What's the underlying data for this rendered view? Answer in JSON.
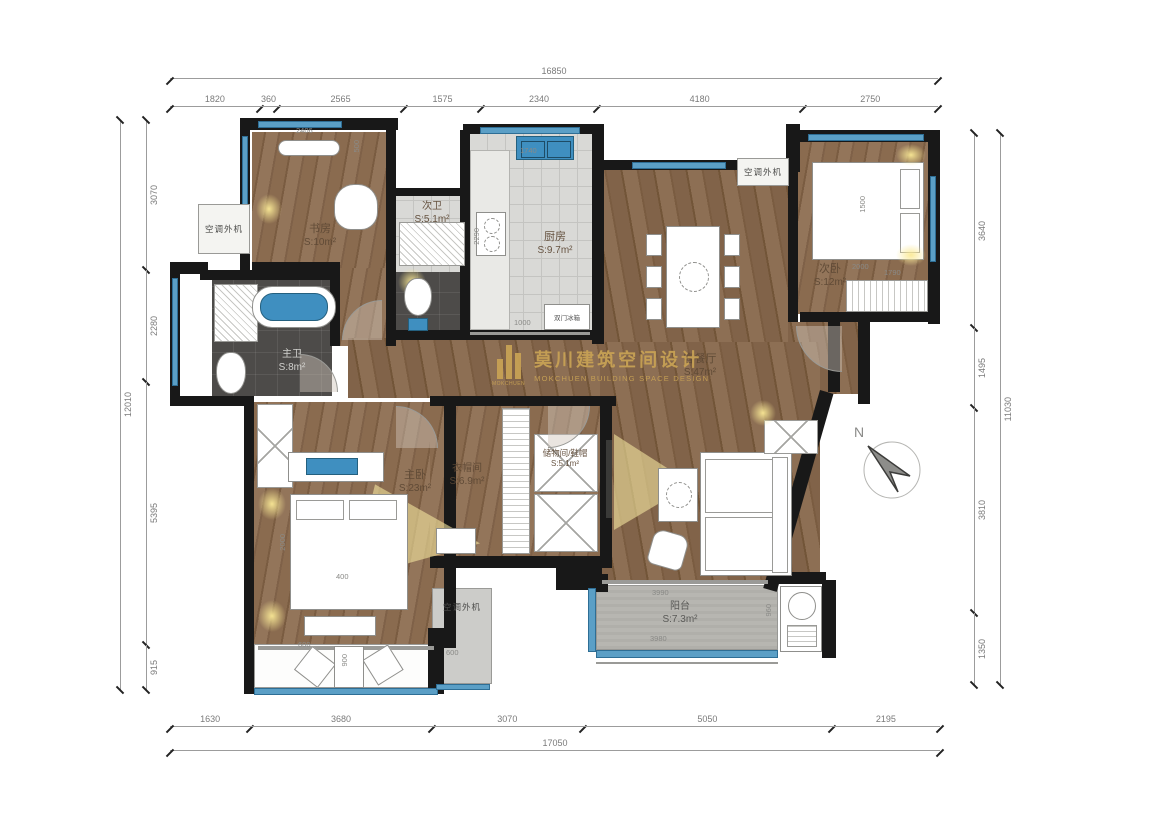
{
  "watermark": {
    "cn": "莫川建筑空间设计",
    "en": "MOKCHUEN BUILDING SPACE DESIGN",
    "logo_caption": "MOKCHUEN",
    "color": "#C9A355"
  },
  "compass": {
    "north_label": "N"
  },
  "dims": {
    "top": {
      "total": "16850",
      "segments": [
        "1820",
        "360",
        "2565",
        "1575",
        "2340",
        "4180",
        "2750"
      ]
    },
    "bottom": {
      "total": "17050",
      "segments": [
        "1630",
        "3680",
        "3070",
        "5050",
        "2195"
      ]
    },
    "left": {
      "total": "12010",
      "segments": [
        "3070",
        "2280",
        "5395",
        "915"
      ]
    },
    "right": {
      "total": "11030",
      "segments": [
        "3640",
        "1495",
        "3810",
        "1350"
      ]
    }
  },
  "rooms": {
    "study": {
      "name": "书房",
      "area": "S:10m²"
    },
    "guest_bath": {
      "name": "次卫",
      "area": "S:5.1m²"
    },
    "kitchen": {
      "name": "厨房",
      "area": "S:9.7m²"
    },
    "living_dining": {
      "name": "客餐厅",
      "area": "S:47m²"
    },
    "guest_bedroom": {
      "name": "次卧",
      "area": "S:12m²"
    },
    "master_bath": {
      "name": "主卫",
      "area": "S:8m²"
    },
    "master_bedroom": {
      "name": "主卧",
      "area": "S:23m²"
    },
    "closet": {
      "name": "衣帽间",
      "area": "S:6.9m²"
    },
    "storage": {
      "name": "储物间/鞋帽",
      "area": "S:5.1m²"
    },
    "balcony": {
      "name": "阳台",
      "area": "S:7.3m²"
    }
  },
  "labels": {
    "ac_unit": "空调外机",
    "fridge": "双门冰箱"
  },
  "small_dims": [
    "2406",
    "500",
    "1740",
    "2290",
    "1000",
    "1500",
    "2000",
    "1790",
    "2000",
    "400",
    "3990",
    "3980",
    "960",
    "900",
    "600",
    "600"
  ]
}
